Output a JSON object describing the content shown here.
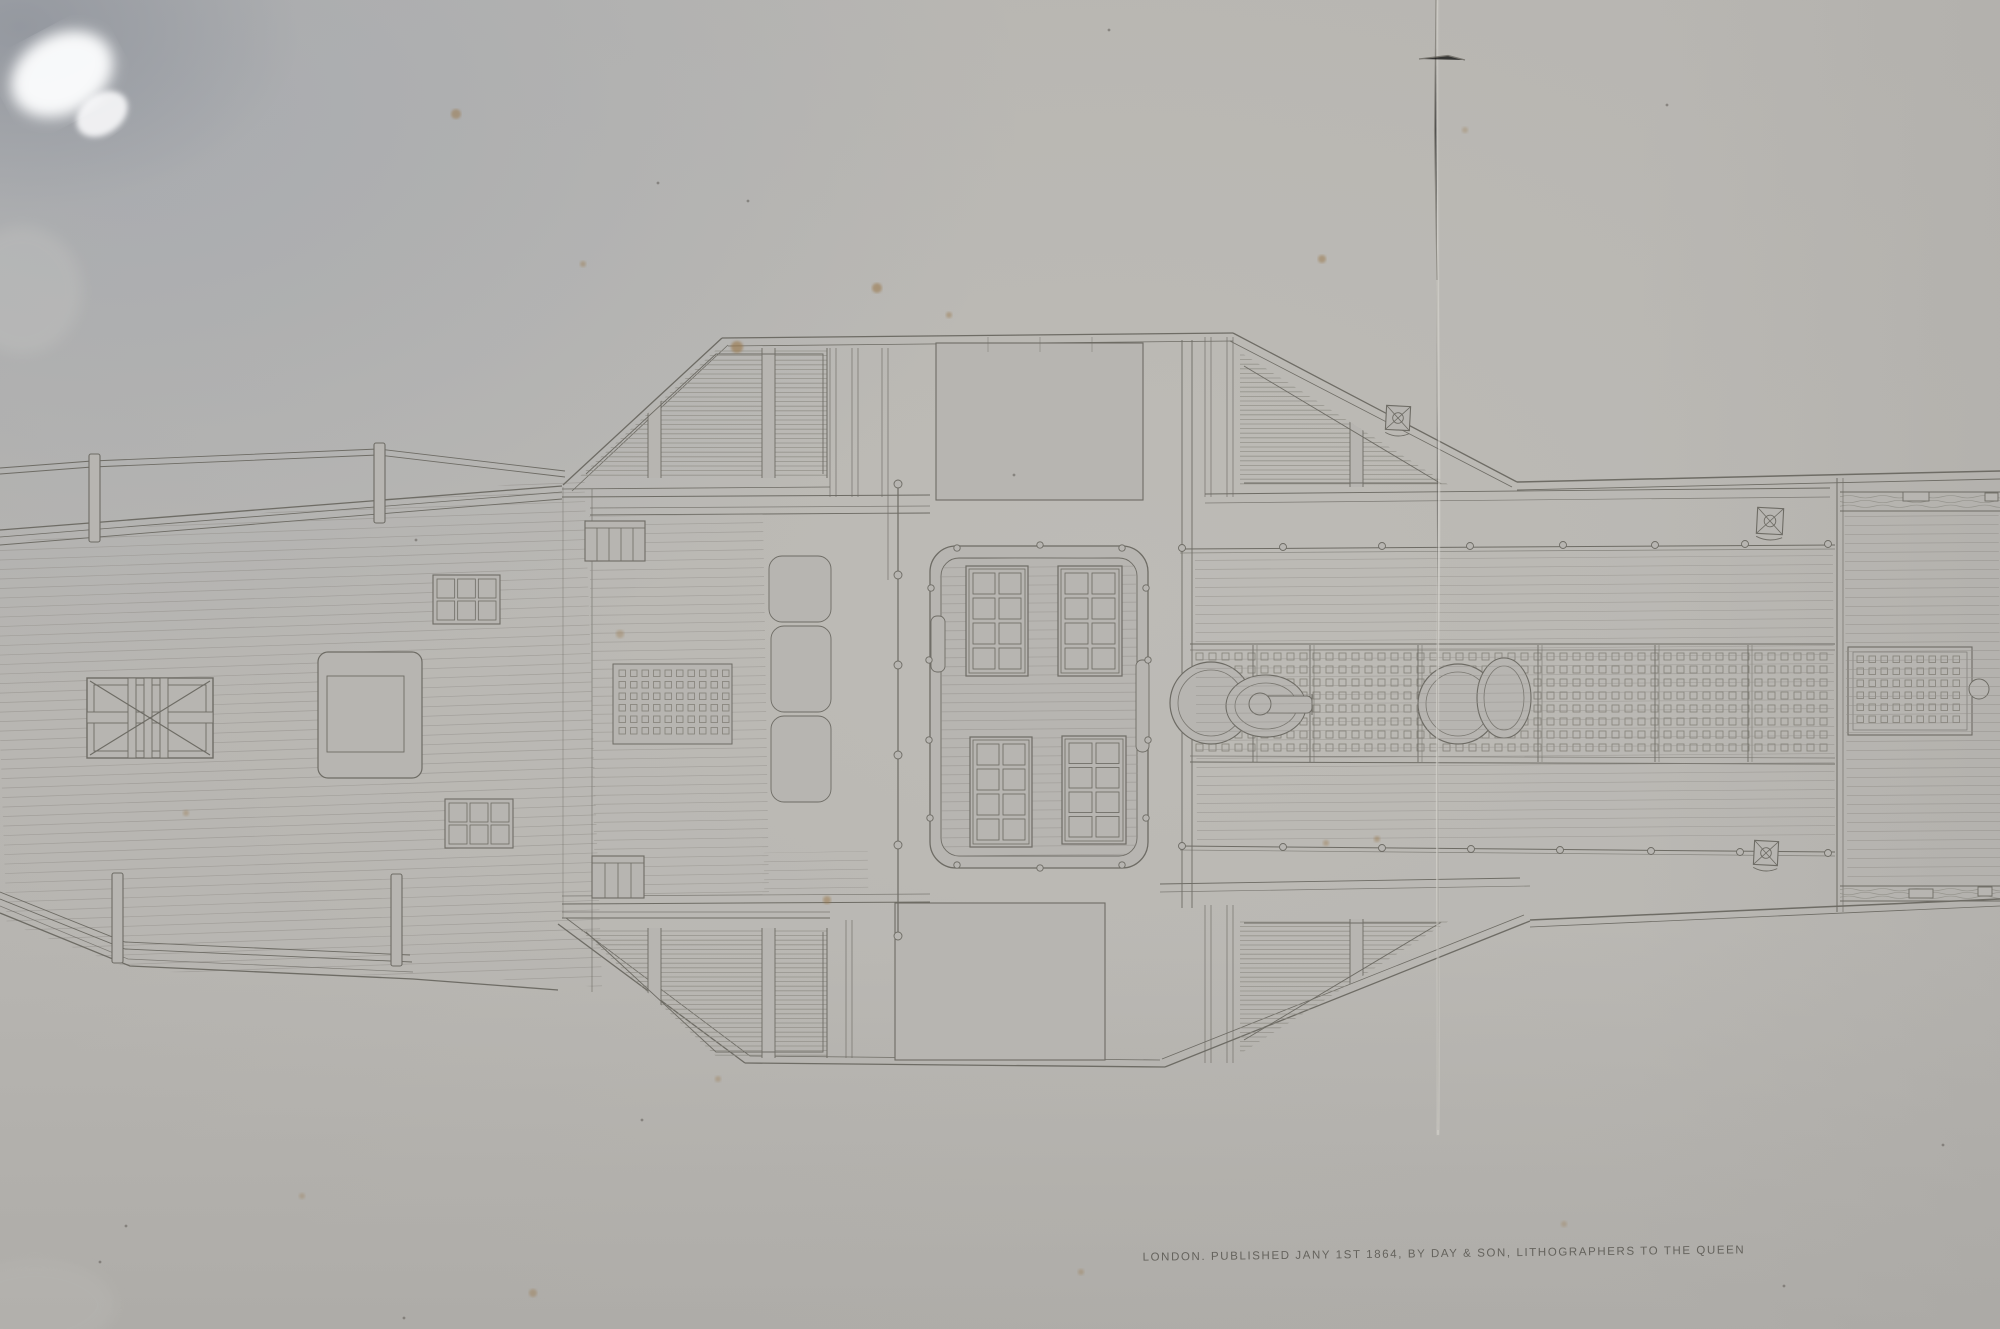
{
  "photo": {
    "description": "Photograph of a framed 1864 lithograph: deck plan of a paddle steamer, seen under glass with glare and a vertical fold crease",
    "caption": "LONDON. PUBLISHED JANY 1ST 1864, BY DAY & SON, LITHOGRAPHERS TO THE QUEEN"
  },
  "colors": {
    "paper": "#b7b5b1",
    "paper_light": "#c2c0ba",
    "paper_cool": "#a9adb4",
    "ink_line": "#6e6c65",
    "ink_light": "#8f8d86",
    "plank_line": "#92908a",
    "crease_light": "#d6d4ce",
    "crease_dark": "#6a675f",
    "glare": "#fbfcfd",
    "foxing": "#997647",
    "caption_ink": "#5a5852"
  },
  "plan_parts": [
    "port deck",
    "bow railing",
    "x-braced skylight hatch",
    "deckhouse roof",
    "companion stairs",
    "paddle-box louvres",
    "engine-room skylight",
    "central skylight enclosure",
    "window grids",
    "capstan and winch drums",
    "deck grating band",
    "side grating",
    "stern deck",
    "wood-grain bulwark",
    "mooring bitts"
  ]
}
